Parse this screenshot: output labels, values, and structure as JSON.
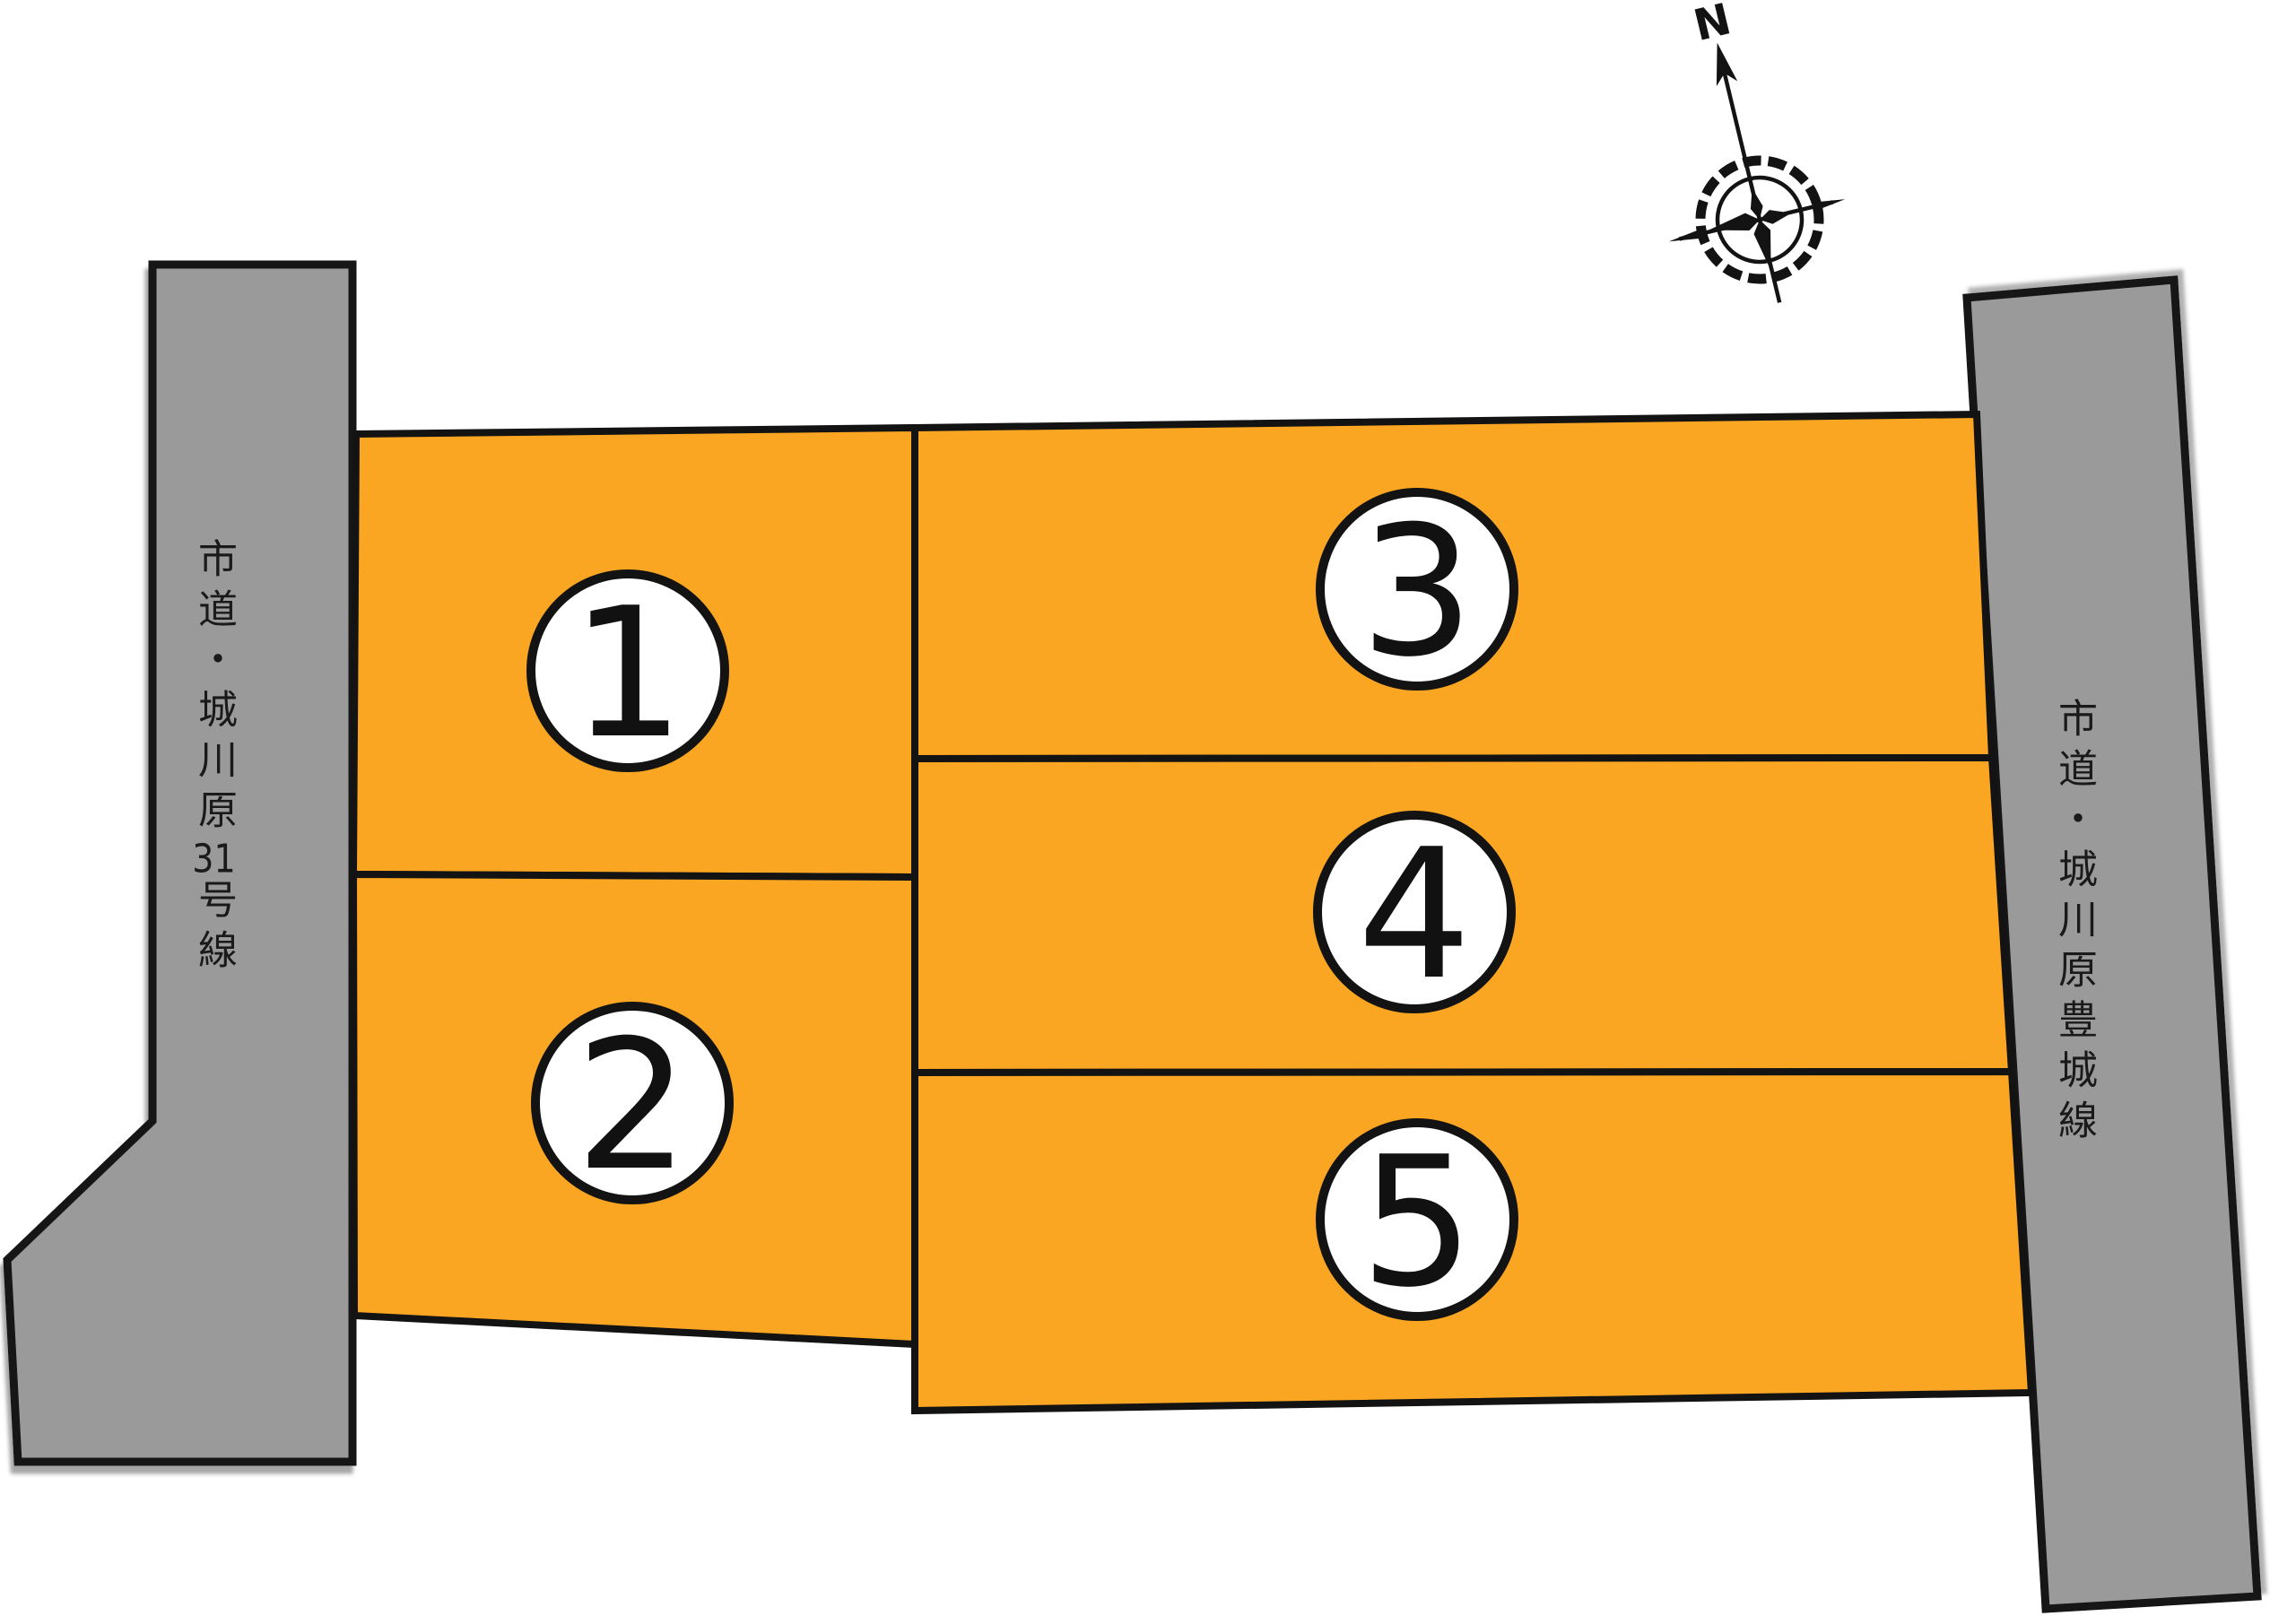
{
  "roads": {
    "left": {
      "name": "市道・城川原31号線",
      "name_part1": "市道・城川原",
      "name_number": "31",
      "name_part2": "号線"
    },
    "right": {
      "name": "市道・城川原豊城線"
    }
  },
  "lots": [
    {
      "number": "1"
    },
    {
      "number": "2"
    },
    {
      "number": "3"
    },
    {
      "number": "4"
    },
    {
      "number": "5"
    }
  ],
  "compass": {
    "north_label": "N"
  },
  "colors": {
    "lot_fill": "#FAA622",
    "road_fill": "#9A9A9A",
    "outline": "#131313",
    "circle_fill": "#FFFFFF",
    "number_color": "#111111"
  }
}
